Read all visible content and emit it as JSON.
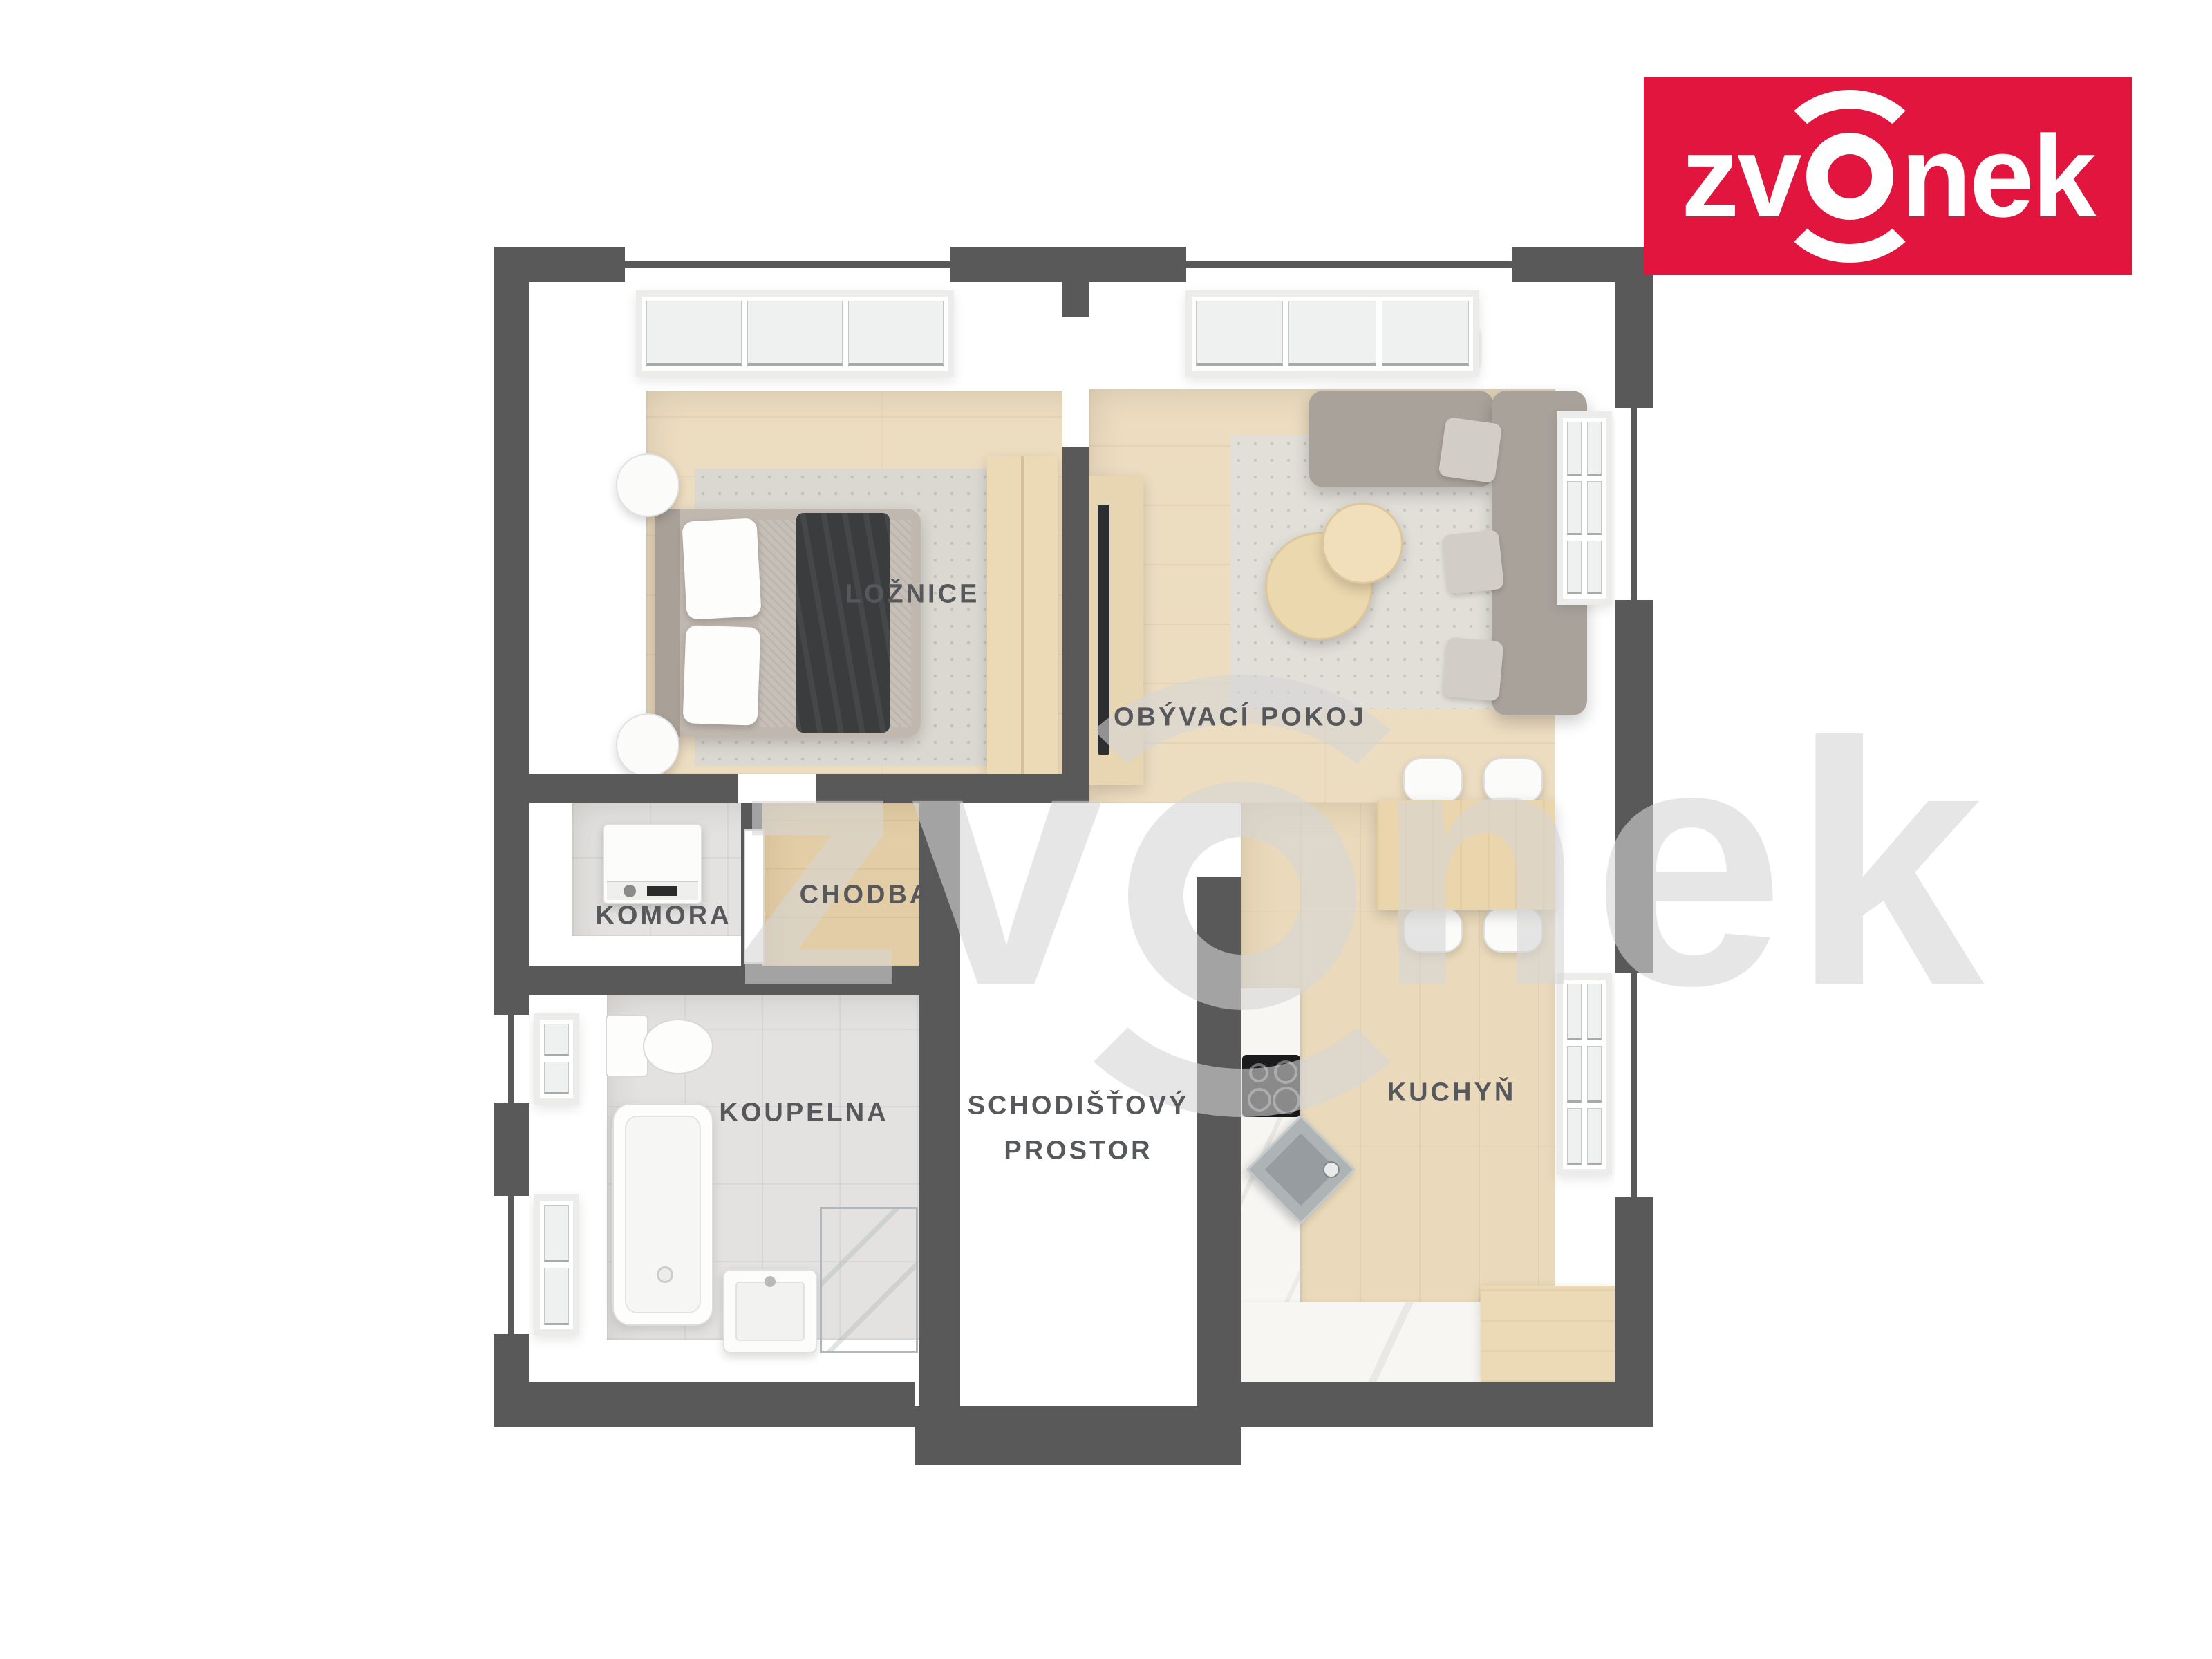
{
  "logo": {
    "text_before_mark": "zv",
    "text_after_mark": "nek",
    "background_color": "#e2153e",
    "text_color": "#ffffff"
  },
  "watermark": {
    "text_before_mark": "zv",
    "text_after_mark": "nek"
  },
  "plan": {
    "wall_color": "#595959",
    "label_color": "#56585b",
    "rooms": {
      "bedroom": {
        "label": "LOŽNICE"
      },
      "living_room": {
        "label": "OBÝVACÍ POKOJ"
      },
      "storage": {
        "label": "KOMORA"
      },
      "hallway": {
        "label": "CHODBA"
      },
      "bathroom": {
        "label": "KOUPELNA"
      },
      "staircase": {
        "label_line1": "SCHODIŠŤOVÝ",
        "label_line2": "PROSTOR"
      },
      "kitchen": {
        "label": "KUCHYŇ"
      }
    }
  }
}
